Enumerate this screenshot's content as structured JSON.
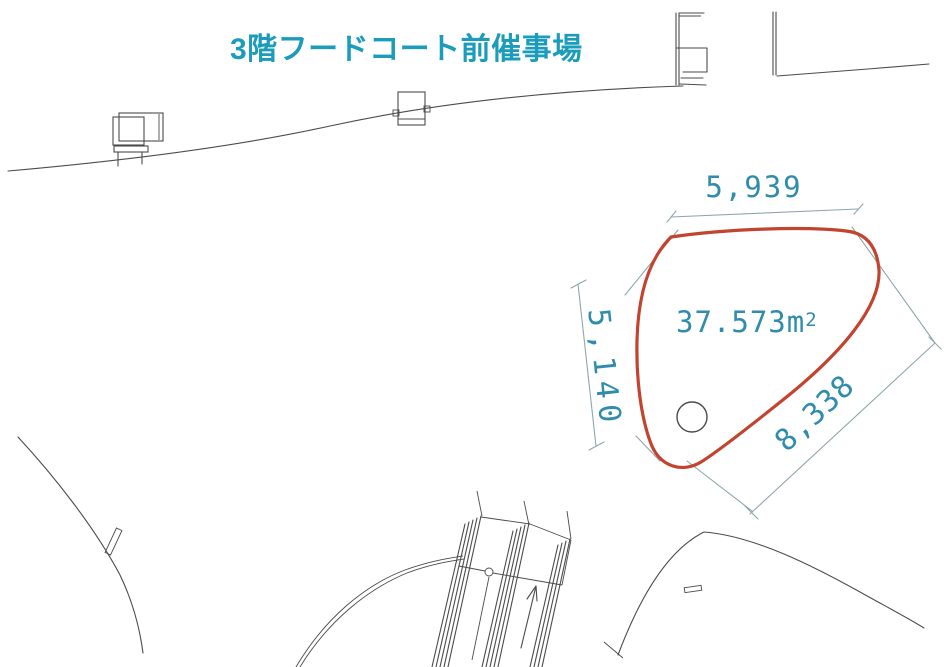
{
  "title": "3階フードコート前催事場",
  "event_space": {
    "area_label": "37.573m",
    "area_sup": "2",
    "dimensions": {
      "top": "5,939",
      "left": "5,140",
      "right": "8,338"
    }
  },
  "colors": {
    "background": "#ffffff",
    "title": "#1a9cba",
    "dimension_text": "#2f8cad",
    "area_outline": "#c2442f",
    "plan_line": "#4b4b4b",
    "dim_line": "#8fa6ac"
  }
}
